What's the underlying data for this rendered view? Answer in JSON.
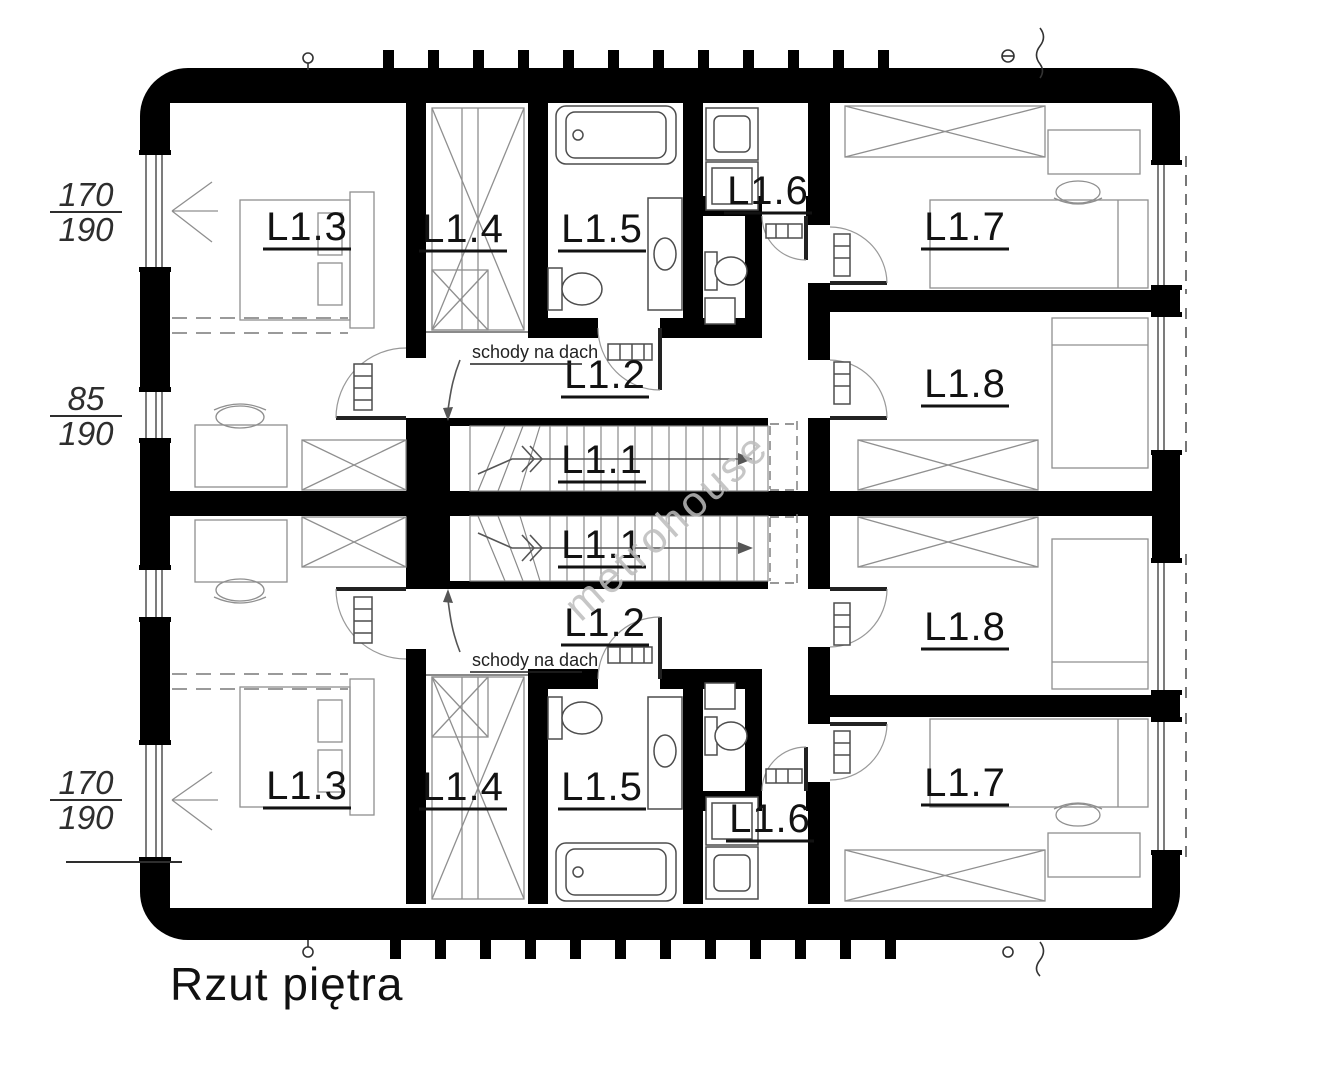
{
  "drawing": {
    "title": "Rzut piętra",
    "watermark": "metrohouse",
    "stairs_note": "schody na dach",
    "rooms": {
      "l1_1": "L1.1",
      "l1_2": "L1.2",
      "l1_3": "L1.3",
      "l1_4": "L1.4",
      "l1_5": "L1.5",
      "l1_6": "L1.6",
      "l1_7": "L1.7",
      "l1_8": "L1.8"
    },
    "dimensions": {
      "left_top": {
        "num": "170",
        "den": "190"
      },
      "left_middle": {
        "num": "85",
        "den": "190"
      },
      "left_bottom": {
        "num": "170",
        "den": "190"
      }
    }
  }
}
